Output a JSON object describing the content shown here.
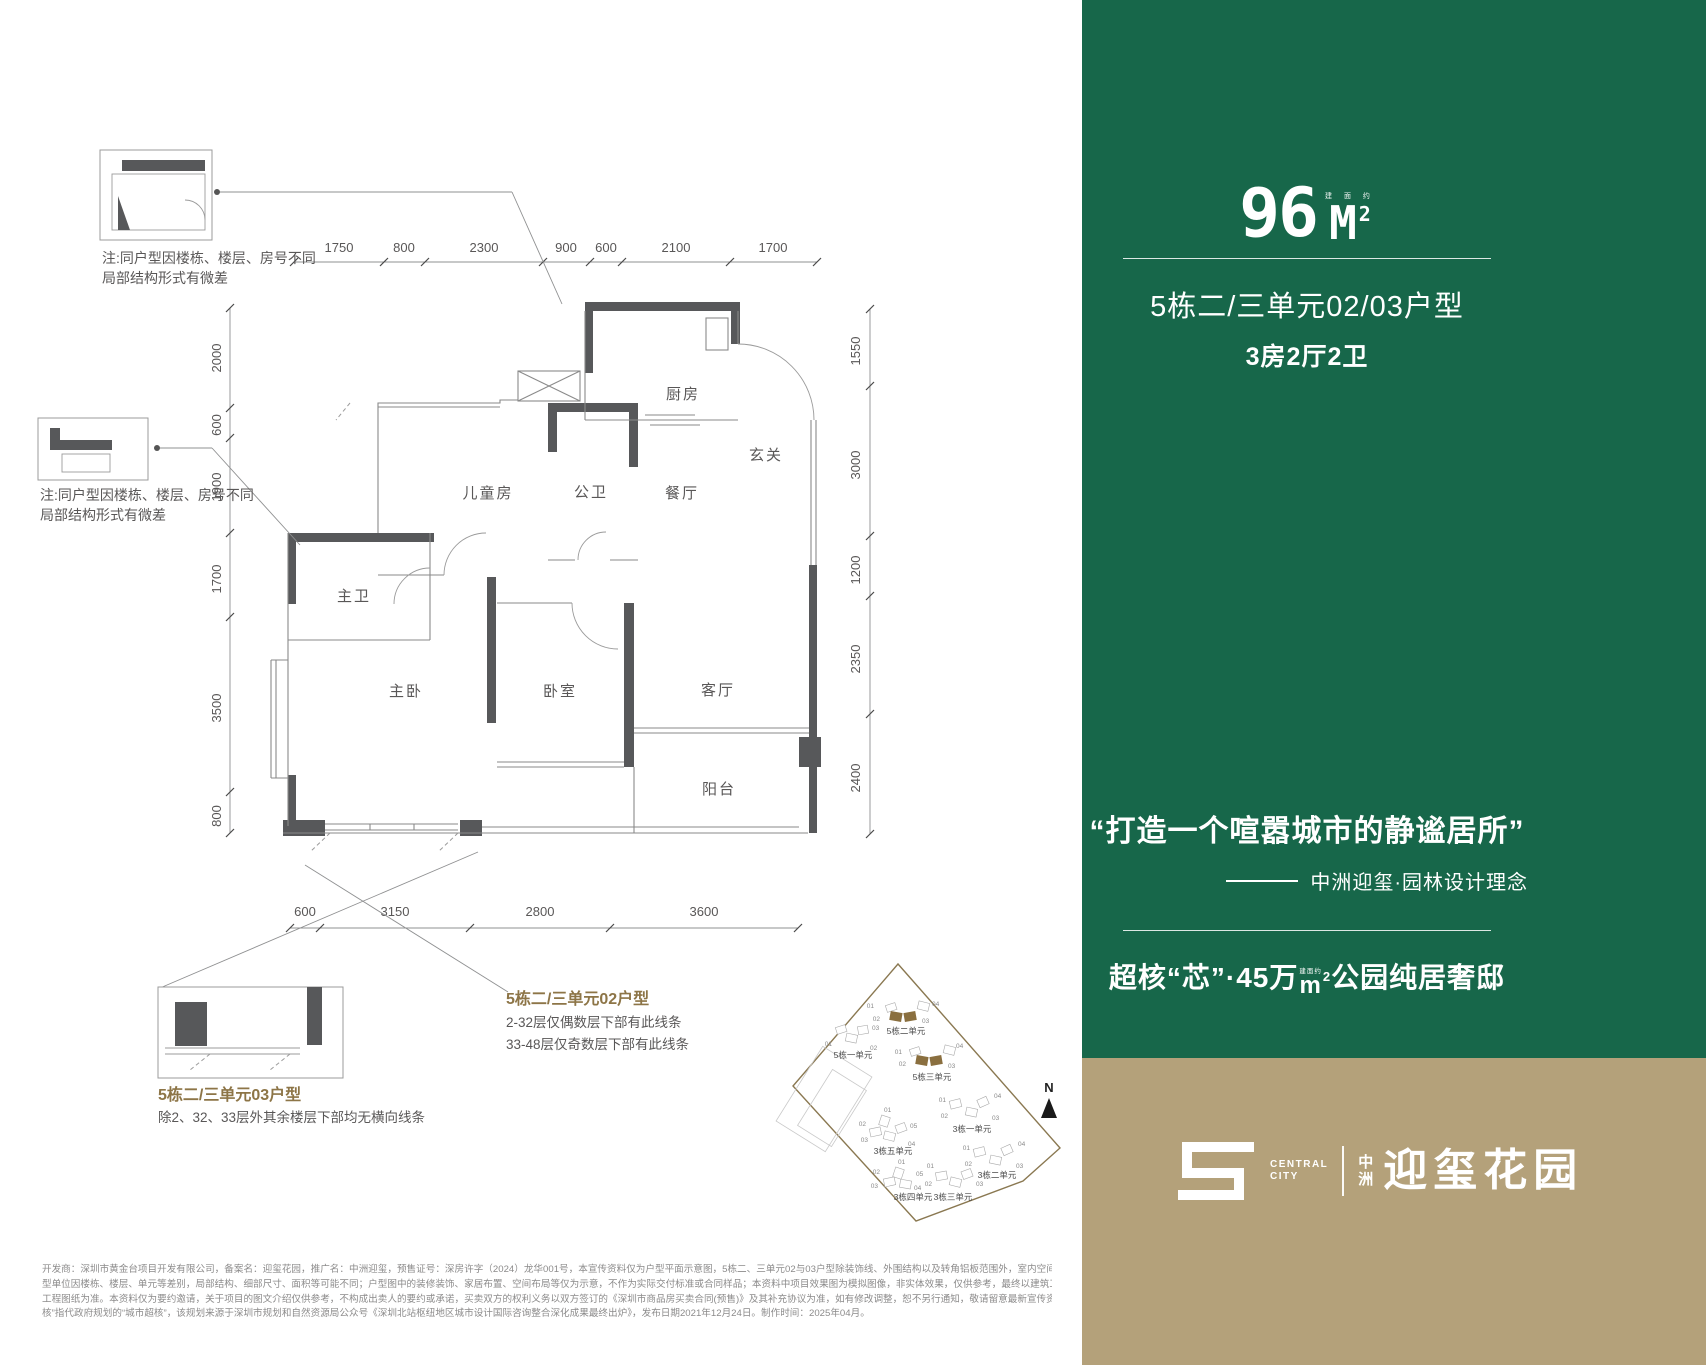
{
  "plan": {
    "notes": {
      "note1_line1": "注:同户型因楼栋、楼层、房号不同",
      "note1_line2": "局部结构形式有微差",
      "note2_line1": "注:同户型因楼栋、楼层、房号不同",
      "note2_line2": "局部结构形式有微差"
    },
    "rooms": {
      "kitchen": "厨房",
      "entry": "玄关",
      "dining": "餐厅",
      "guest_bath": "公卫",
      "kids_room": "儿童房",
      "master_bath": "主卫",
      "master_bed": "主卧",
      "bedroom": "卧室",
      "living": "客厅",
      "balcony": "阳台"
    },
    "dims": {
      "top": [
        "1750",
        "800",
        "2300",
        "900",
        "600",
        "2100",
        "1700"
      ],
      "left": [
        "2000",
        "600",
        "1900",
        "1700",
        "3500",
        "800"
      ],
      "right": [
        "1550",
        "3000",
        "1200",
        "2350",
        "2400"
      ],
      "bottom": [
        "600",
        "3150",
        "2800",
        "3600"
      ]
    },
    "callout02": {
      "title": "5栋二/三单元02户型",
      "line1": "2-32层仅偶数层下部有此线条",
      "line2": "33-48层仅奇数层下部有此线条"
    },
    "callout03": {
      "title": "5栋二/三单元03户型",
      "line1": "除2、32、33层外其余楼层下部均无横向线条"
    }
  },
  "site": {
    "compass": "N",
    "clusters": [
      {
        "label": "5栋二单元",
        "nums": [
          "01",
          "02",
          "03",
          "04"
        ]
      },
      {
        "label": "5栋一单元",
        "nums": [
          "01",
          "02",
          "03"
        ]
      },
      {
        "label": "5栋三单元",
        "nums": [
          "01",
          "02",
          "03",
          "04"
        ]
      },
      {
        "label": "3栋一单元",
        "nums": [
          "01",
          "02",
          "03",
          "04"
        ]
      },
      {
        "label": "3栋五单元",
        "nums": [
          "01",
          "02",
          "03",
          "04",
          "05"
        ]
      },
      {
        "label": "3栋二单元",
        "nums": [
          "01",
          "02",
          "03",
          "04"
        ]
      },
      {
        "label": "3栋四单元",
        "nums": [
          "01",
          "02",
          "03",
          "04",
          "05"
        ]
      },
      {
        "label": "3栋三单元",
        "nums": [
          "01",
          "02",
          "03"
        ]
      }
    ]
  },
  "panel": {
    "area_num": "96",
    "area_unit": "M",
    "area_sup": "2",
    "area_approx": "建 面 约",
    "title": "5栋二/三单元02/03户型",
    "subtitle": "3房2厅2卫",
    "quote": "“打造一个喧嚣城市的静谧居所”",
    "attribution": "中洲迎玺·园林设计理念",
    "headline2_pre": "超核“芯”·45万",
    "headline2_unit_label": "建面约",
    "headline2_unit": "m",
    "headline2_sup": "2",
    "headline2_post": "公园纯居奢邸"
  },
  "logo": {
    "en1": "CENTRAL",
    "en2": "CITY",
    "cn1": "中",
    "cn2": "洲",
    "name": "迎玺花园"
  },
  "disclaimer": {
    "line1": "开发商：深圳市黄金台项目开发有限公司，备案名：迎玺花园，推广名：中洲迎玺，预售证号：深房许字（2024）龙华001号，本宣传资料仅为户型平面示意图，5栋二、三单元02与03户型除装饰线、外围结构以及转角铝板范围外，室内空间完全镜像，相同户",
    "line2": "型单位因楼栋、楼层、单元等差别，局部结构、细部尺寸、面积等可能不同；户型图中的装修装饰、家居布置、空间布局等仅为示意，不作为实际交付标准或合同样品；本资料中项目效果图为模拟图像，非实体效果，仅供参考，最终以建筑工程施工许可及其对应",
    "line3": "工程图纸为准。本资料仅为要约邀请，关于项目的图文介绍仅供参考，不构成出卖人的要约或承诺，买卖双方的权利义务以双方签订的《深圳市商品房买卖合同(预售)》及其补充协议为准，如有修改调整，恕不另行通知，敬请留意最新宣传资料，信息来源：“超",
    "line4": "核”指代政府规划的“城市超核”，该规划来源于深圳市规划和自然资源局公众号《深圳北站枢纽地区城市设计国际咨询整合深化成果最终出炉》，发布日期2021年12月24日。制作时间：2025年04月。"
  },
  "colors": {
    "green": "#17674a",
    "tan": "#b4a17a",
    "gold": "#8d7547",
    "wall": "#57585a",
    "line": "#8f9091",
    "text": "#595757"
  }
}
